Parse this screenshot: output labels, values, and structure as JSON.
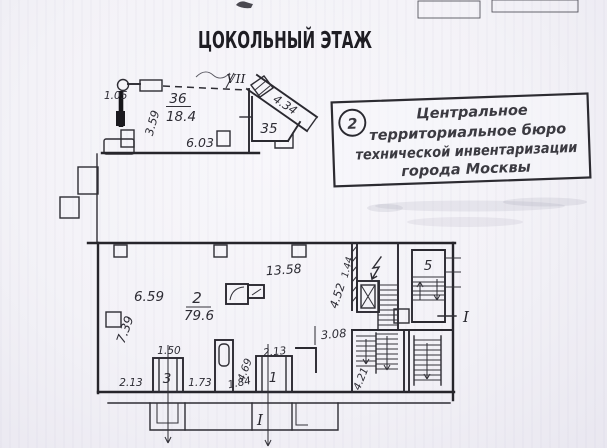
{
  "document": {
    "title": "ЦОКОЛЬНЫЙ ЭТАЖ"
  },
  "stamp": {
    "number": "2",
    "lines": {
      "l1": "Центральное",
      "l2": "территориальное бюро",
      "l3": "технической инвентаризации",
      "l4": "города Москвы"
    }
  },
  "upper": {
    "room36_number": "36",
    "room36_area": "18.4",
    "room35_number": "35",
    "corridor_mark": "VII",
    "dim_door": "1.05",
    "dim_left": "3.59",
    "dim_bottom": "6.03",
    "dim_diagonal": "4.34"
  },
  "main": {
    "room2_number": "2",
    "room2_area": "79.6",
    "room5_number": "5",
    "room3_number": "3",
    "room1_number": "1",
    "dim_top": "13.58",
    "dim_left": "6.59",
    "dim_left_vert": "7.39",
    "dim_right_vert": "4.52",
    "dim_opening": "3.08",
    "dim_wall": "1.44",
    "dim_room3_width": "1.50",
    "dim_seg_left": "2.13",
    "dim_seg_mid": "1.73",
    "dim_seg_right": "1.84",
    "dim_duct": "4.69",
    "dim_room1_width": "2.13",
    "dim_stair": "4.21"
  },
  "section_marks": {
    "right": "I",
    "bottom": "I"
  }
}
